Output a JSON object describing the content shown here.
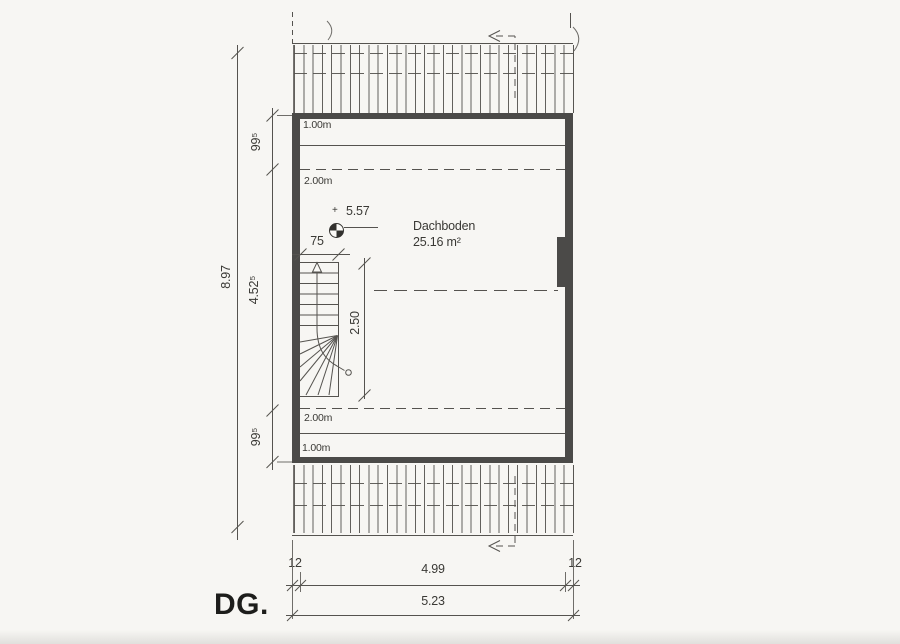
{
  "colors": {
    "line": "#55534f",
    "wall": "#4b4a48",
    "text": "#3a3935",
    "paper": "#f7f6f3",
    "ink": "#1d1d1b"
  },
  "plan": {
    "floor_label": "DG.",
    "room": {
      "name": "Dachboden",
      "area": "25.16 m²"
    },
    "level_marker": {
      "plus": "+",
      "value": "5.57"
    },
    "height_lines": {
      "top_1m": "1.00m",
      "top_2m": "2.00m",
      "bottom_2m": "2.00m",
      "bottom_1m": "1.00m"
    },
    "dims": {
      "total_height": "8.97",
      "top_offset": "99⁵",
      "middle_span": "4.52⁵",
      "bottom_offset": "99⁵",
      "stair_width": "75",
      "stair_run": "2.50",
      "left_wall_thickness": "12",
      "right_wall_thickness": "12",
      "inner_width": "4.99",
      "outer_width": "5.23"
    }
  }
}
